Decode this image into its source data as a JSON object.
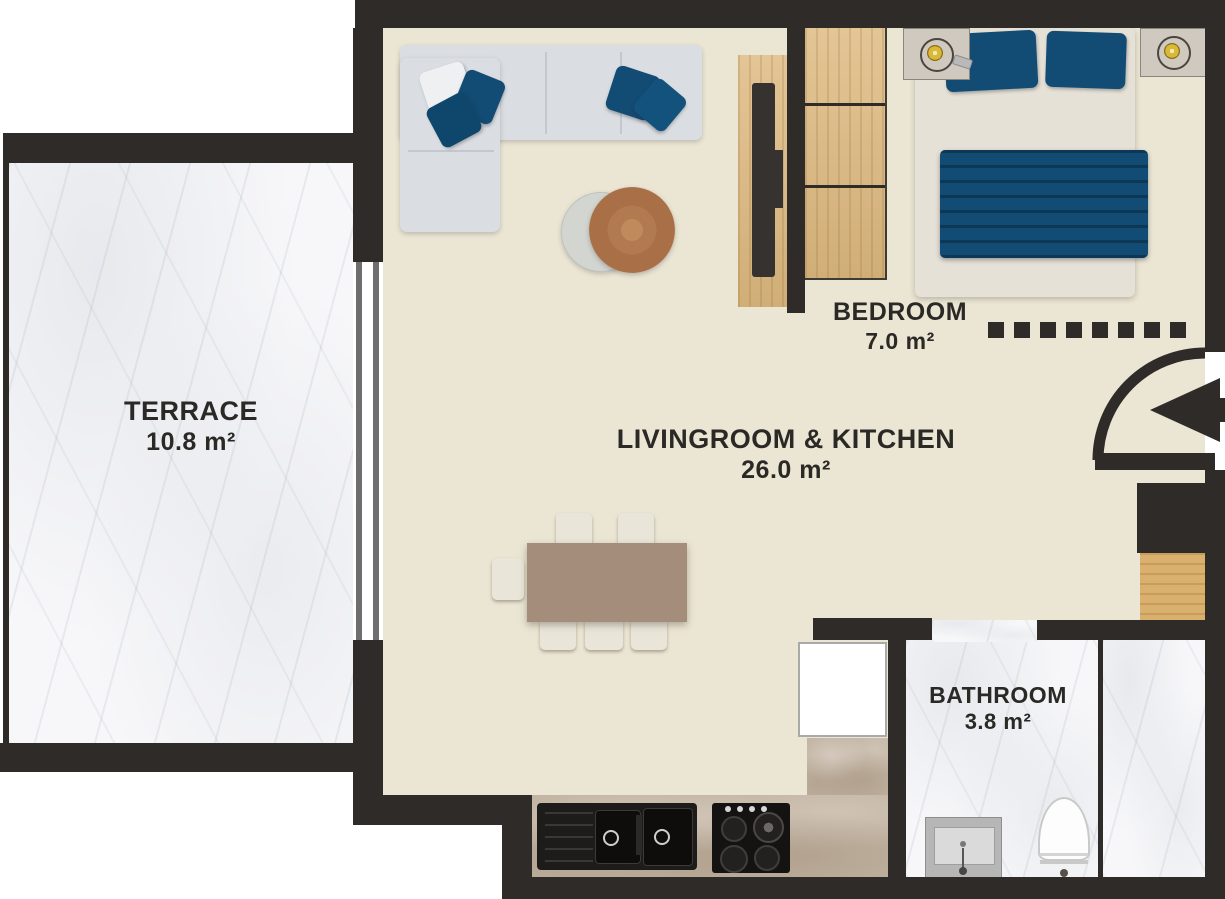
{
  "rooms": [
    {
      "id": "terrace",
      "name": "TERRACE",
      "area": "10.8 m²"
    },
    {
      "id": "livingroom-kitchen",
      "name": "LIVINGROOM & KITCHEN",
      "area": "26.0 m²"
    },
    {
      "id": "bedroom",
      "name": "BEDROOM",
      "area": "7.0 m²"
    },
    {
      "id": "bathroom",
      "name": "BATHROOM",
      "area": "3.8 m²"
    }
  ],
  "colors": {
    "wall": "#2e2b28",
    "floor": "#ebe5d3",
    "marble": "#f7f7f9",
    "wood": "#ddb97f",
    "counter": "#c1b2a0",
    "navy": "#124b74",
    "sofa": "#dadde1",
    "table": "#a58d7b"
  },
  "partition": {
    "dashed_segments": 8
  },
  "entrance": {
    "arrow_icon": "entry-arrow-left",
    "door_icon": "door-swing-arc"
  },
  "furniture_icons": [
    "corner-sofa",
    "coffee-table",
    "tv-unit",
    "tv-screen",
    "wardrobe",
    "double-bed",
    "pillow",
    "blanket",
    "nightstand",
    "lamp",
    "dining-table",
    "dining-chair",
    "kitchen-sink",
    "gas-hob",
    "bathroom-vanity",
    "toilet",
    "window-sliding-door"
  ]
}
